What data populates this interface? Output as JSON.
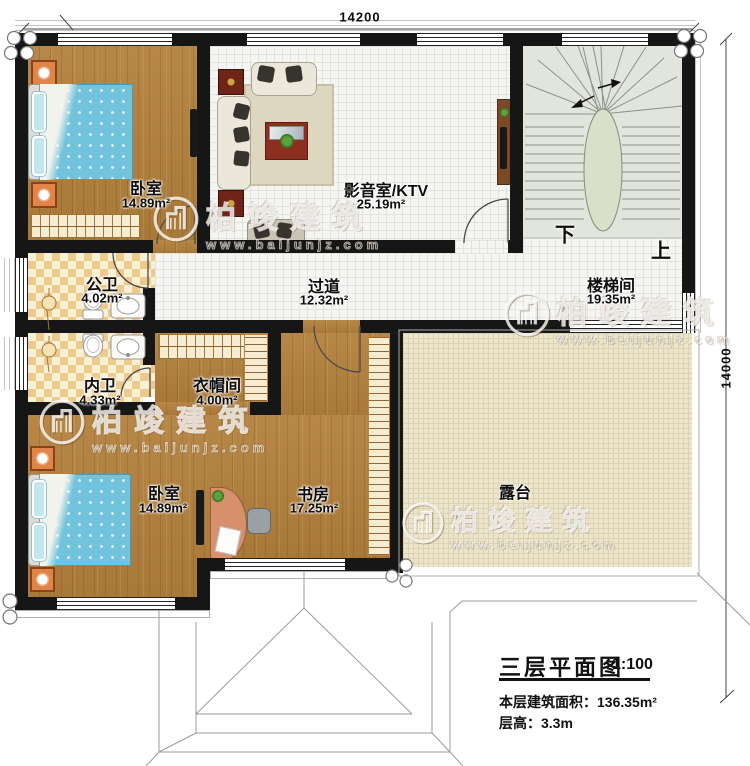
{
  "dimensions": {
    "top": "14200",
    "right": "14000"
  },
  "rooms": [
    {
      "id": "bedroom-1",
      "name": "卧室",
      "area": "14.89m²"
    },
    {
      "id": "media-room",
      "name": "影音室/KTV",
      "area": "25.19m²"
    },
    {
      "id": "stairwell",
      "name": "楼梯间",
      "area": "19.35m²"
    },
    {
      "id": "hallway",
      "name": "过道",
      "area": "12.32m²"
    },
    {
      "id": "public-bath",
      "name": "公卫",
      "area": "4.02m²"
    },
    {
      "id": "ensuite-bath",
      "name": "内卫",
      "area": "4.33m²"
    },
    {
      "id": "cloakroom",
      "name": "衣帽间",
      "area": "4.00m²"
    },
    {
      "id": "bedroom-2",
      "name": "卧室",
      "area": "14.89m²"
    },
    {
      "id": "study",
      "name": "书房",
      "area": "17.25m²"
    },
    {
      "id": "terrace",
      "name": "露台",
      "area": ""
    }
  ],
  "stairs": {
    "down_label": "下",
    "up_label": "上"
  },
  "title_block": {
    "title": "三层平面图",
    "scale": "1:100",
    "floor_area_label": "本层建筑面积：",
    "floor_area_value": "136.35m²",
    "floor_height_label": "层高：",
    "floor_height_value": "3.3m"
  },
  "watermark": {
    "brand": "柏竣建筑",
    "url": "www.baijunjz.com"
  }
}
